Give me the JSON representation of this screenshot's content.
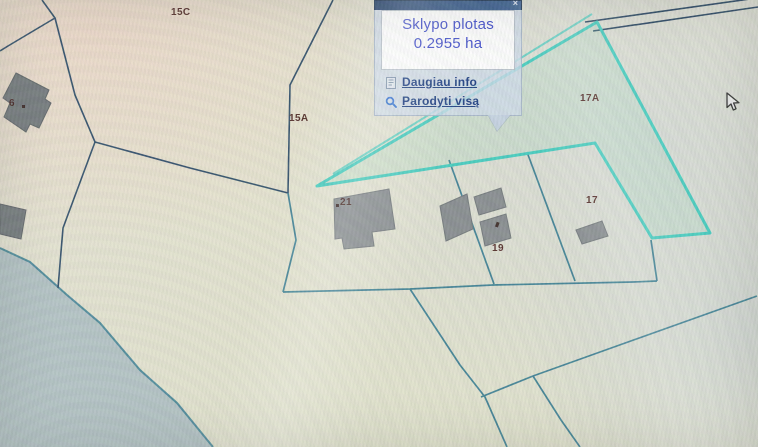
{
  "app": {
    "description_label": "cadastral map viewer with parcel identify popup"
  },
  "popup": {
    "close_label": "×",
    "area_label": "Sklypo plotas",
    "area_value": "0.2955 ha",
    "links": [
      {
        "label": "Daugiau info",
        "icon": "document-icon"
      },
      {
        "label": "Parodyti visą",
        "icon": "magnifier-icon"
      }
    ]
  },
  "map": {
    "labels": [
      {
        "text": "15C"
      },
      {
        "text": "15A"
      },
      {
        "text": "17A"
      },
      {
        "text": "21"
      },
      {
        "text": "19"
      },
      {
        "text": "17"
      },
      {
        "text": "6"
      }
    ],
    "selected_parcel": {
      "label": "17A",
      "area": "0.2955 ha"
    },
    "colors": {
      "highlight": "#3ecbbd",
      "boundary_navy": "#2b4a66",
      "boundary_teal": "#3a7e92",
      "building_gray": "#84898c",
      "building_dark": "#6f7578",
      "water_area": "#aebfc2",
      "popup_header": "#2c5184",
      "popup_value_blue": "#3a47c9",
      "link_navy": "#16387e",
      "label_maroon": "#4e2621"
    },
    "icons": {
      "cursor": "arrow-cursor-icon"
    }
  }
}
